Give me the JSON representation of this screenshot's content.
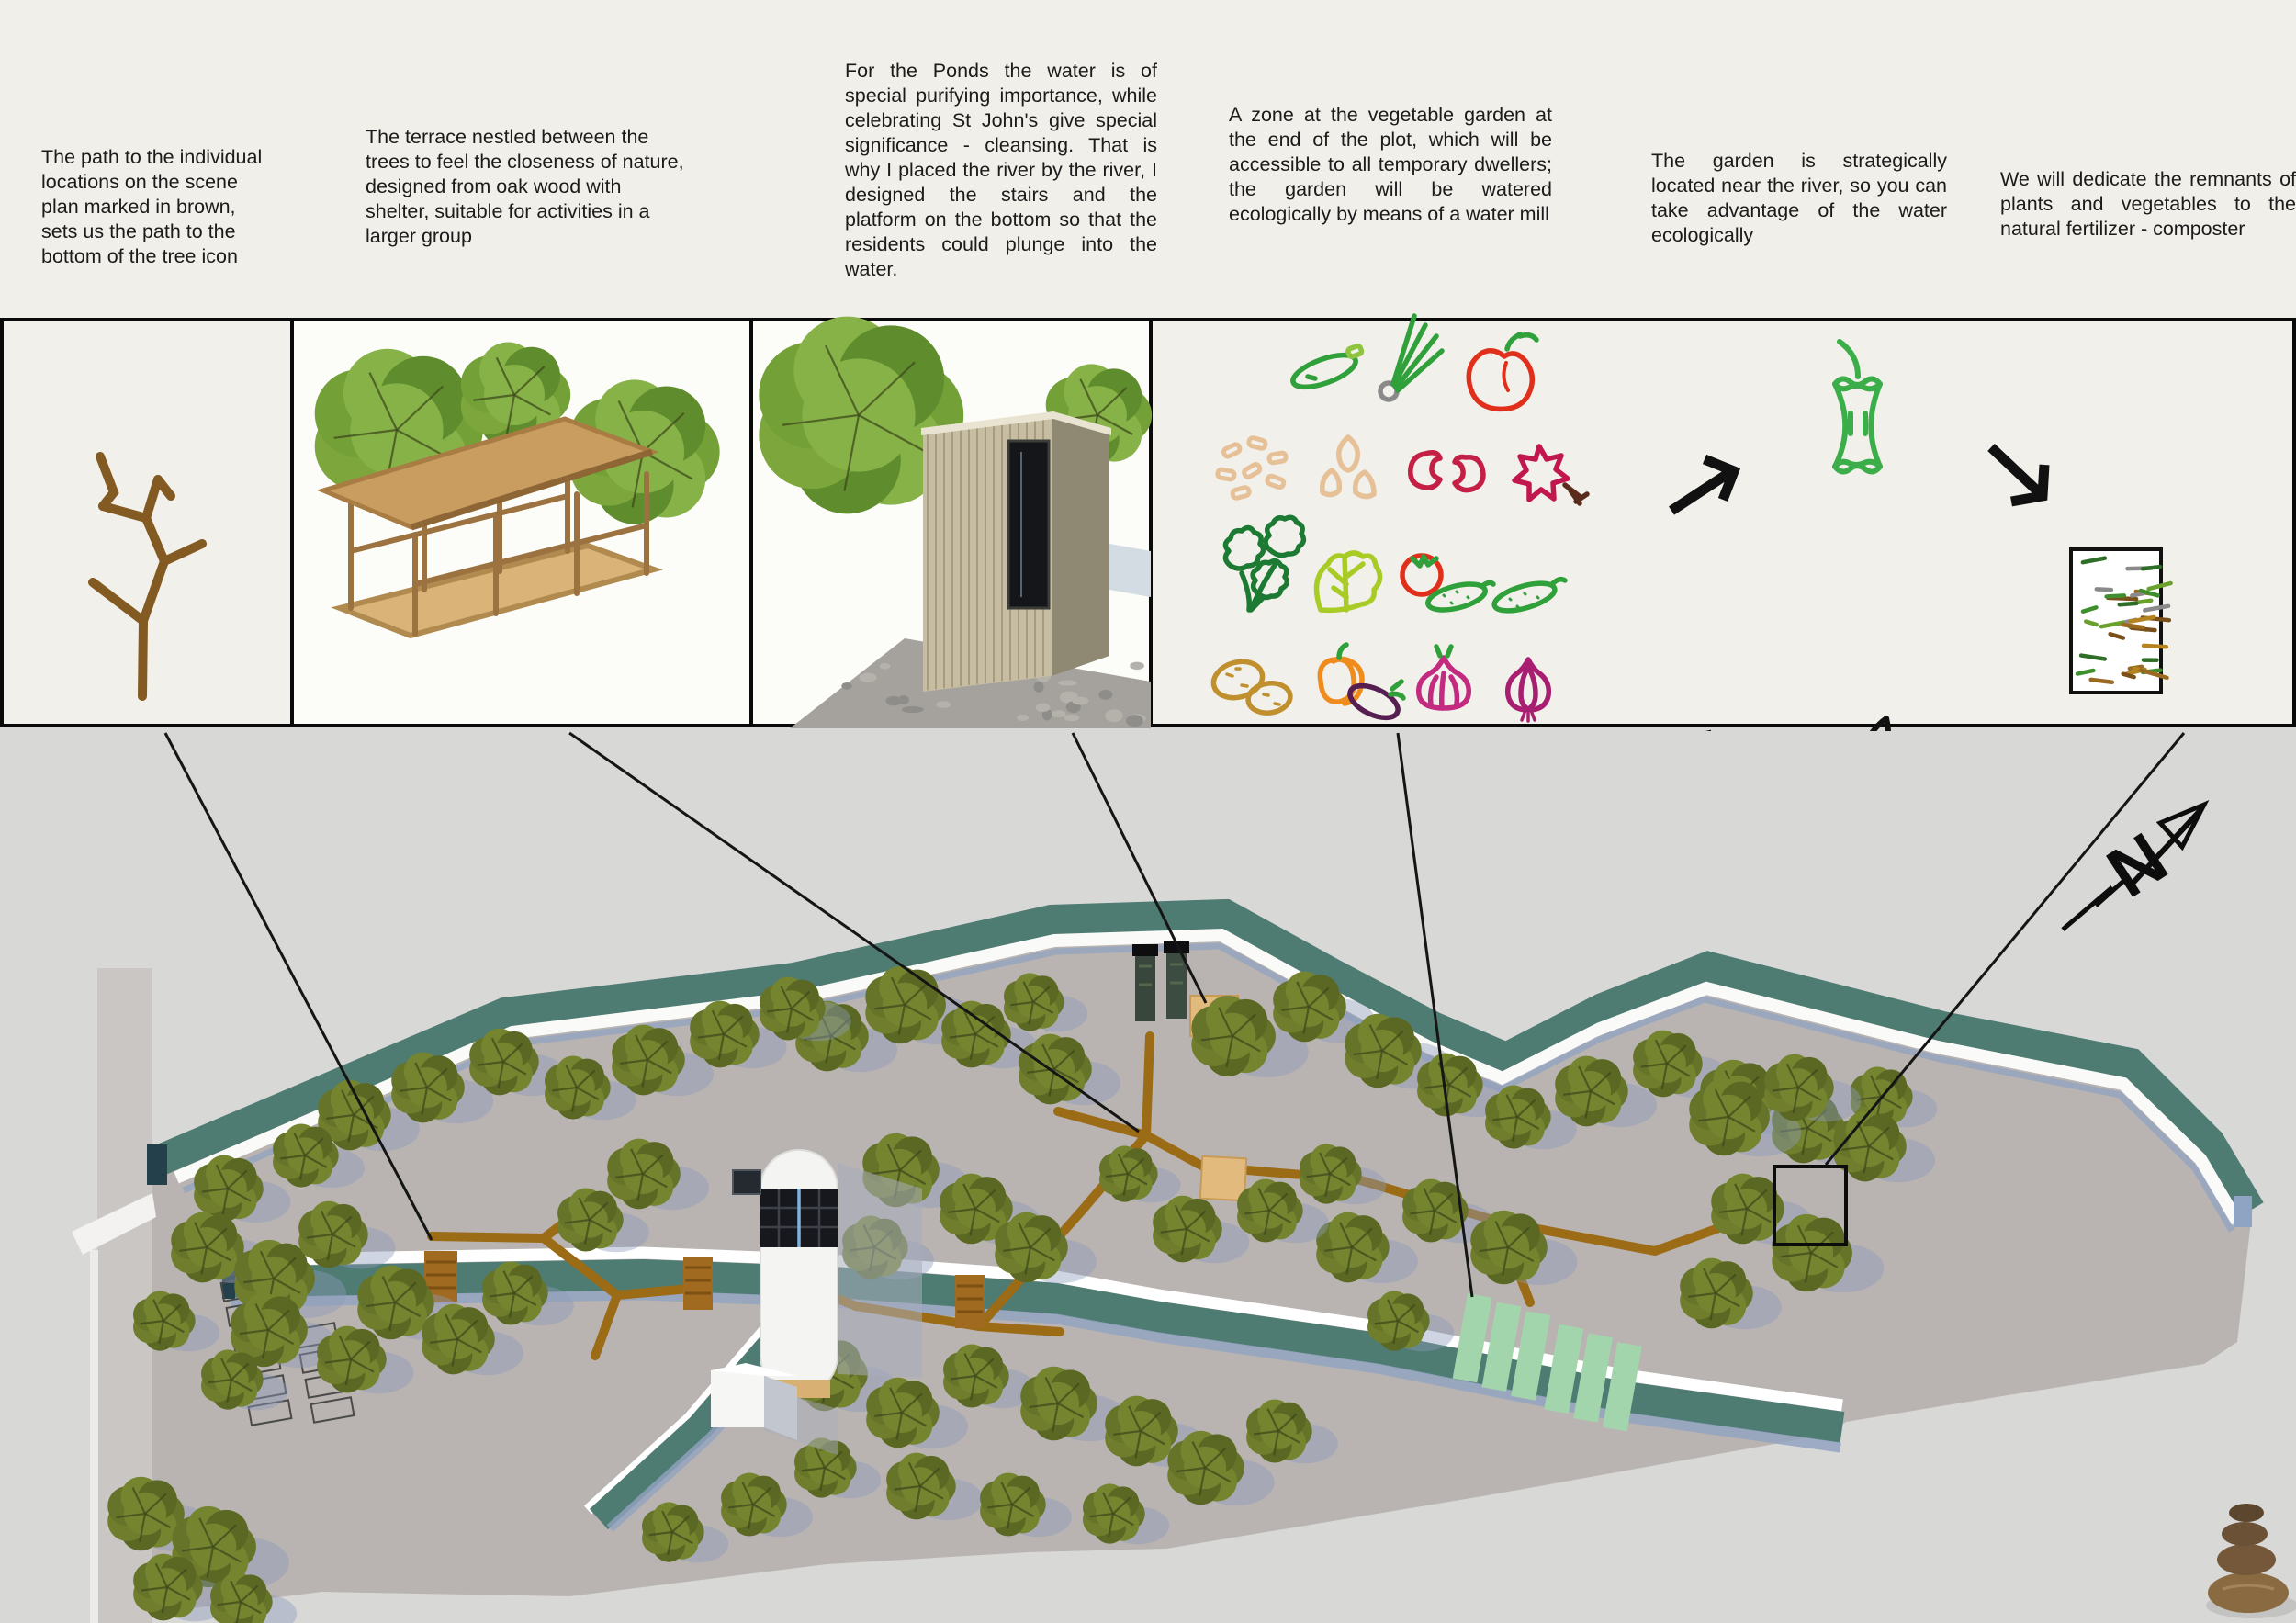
{
  "annotations": {
    "path_note": "The path to the individual locations on the scene plan marked in brown, sets us the path to the bottom of the tree icon",
    "terrace_note": "The terrace nestled between the trees to feel the closeness of nature, designed from oak wood with shelter, suitable for activities in a larger group",
    "ponds_note": "For the Ponds the water is of special purifying importance, while celebrating St John's give special significance - cleansing. That is why I placed the river by the river, I designed the stairs and the platform on the bottom so that the residents could plunge into the water.",
    "garden_zone_note": "A zone at the vegetable garden at the end of the plot, which will be accessible to all temporary dwellers; the garden will be watered ecologically by means of a water mill",
    "garden_location_note": "The garden is strategically located near the river, so you can take advantage of the water ecologically",
    "composter_note": "We will dedicate the remnants of plants and vegetables to the natural fertilizer - composter"
  },
  "plan": {
    "north_label": "N"
  },
  "panels": {
    "panel1": "tree-path-icon",
    "panel2": "wooden-terrace-render",
    "panel3": "wooden-cabin-render",
    "panel4": "vegetable-garden-compost-diagram"
  },
  "icons": {
    "vegetables": [
      "zucchini",
      "spring-onion",
      "pepper",
      "beans",
      "seeds",
      "kidney-beans",
      "star-anise",
      "parsley",
      "lettuce",
      "tomato-cucumber",
      "cucumber",
      "potatoes",
      "pumpkin-eggplant",
      "garlic",
      "onion"
    ],
    "compost_cycle": [
      "apple-core",
      "arrow-ne",
      "arrow-se",
      "compost-bin",
      "arrow-sw",
      "seedling-hand",
      "arrow-nw"
    ],
    "plan_symbols": [
      "north-arrow",
      "stone-cairn",
      "composter-marker",
      "garden-plots",
      "wood-platform",
      "bridge",
      "tree"
    ]
  },
  "colors": {
    "background_top": "#f1efe9",
    "background_plan": "#d8d8d7",
    "site_ground": "#b9b4b1",
    "river": "#4e7b72",
    "river_shadow": "#93a4c1",
    "path_brown": "#9c6b15",
    "tree_green": "#6b7a2a",
    "garden_green": "#a3d5ad",
    "wood": "#e3ba7e",
    "apple_green": "#3bae4a",
    "ink": "#111111"
  }
}
